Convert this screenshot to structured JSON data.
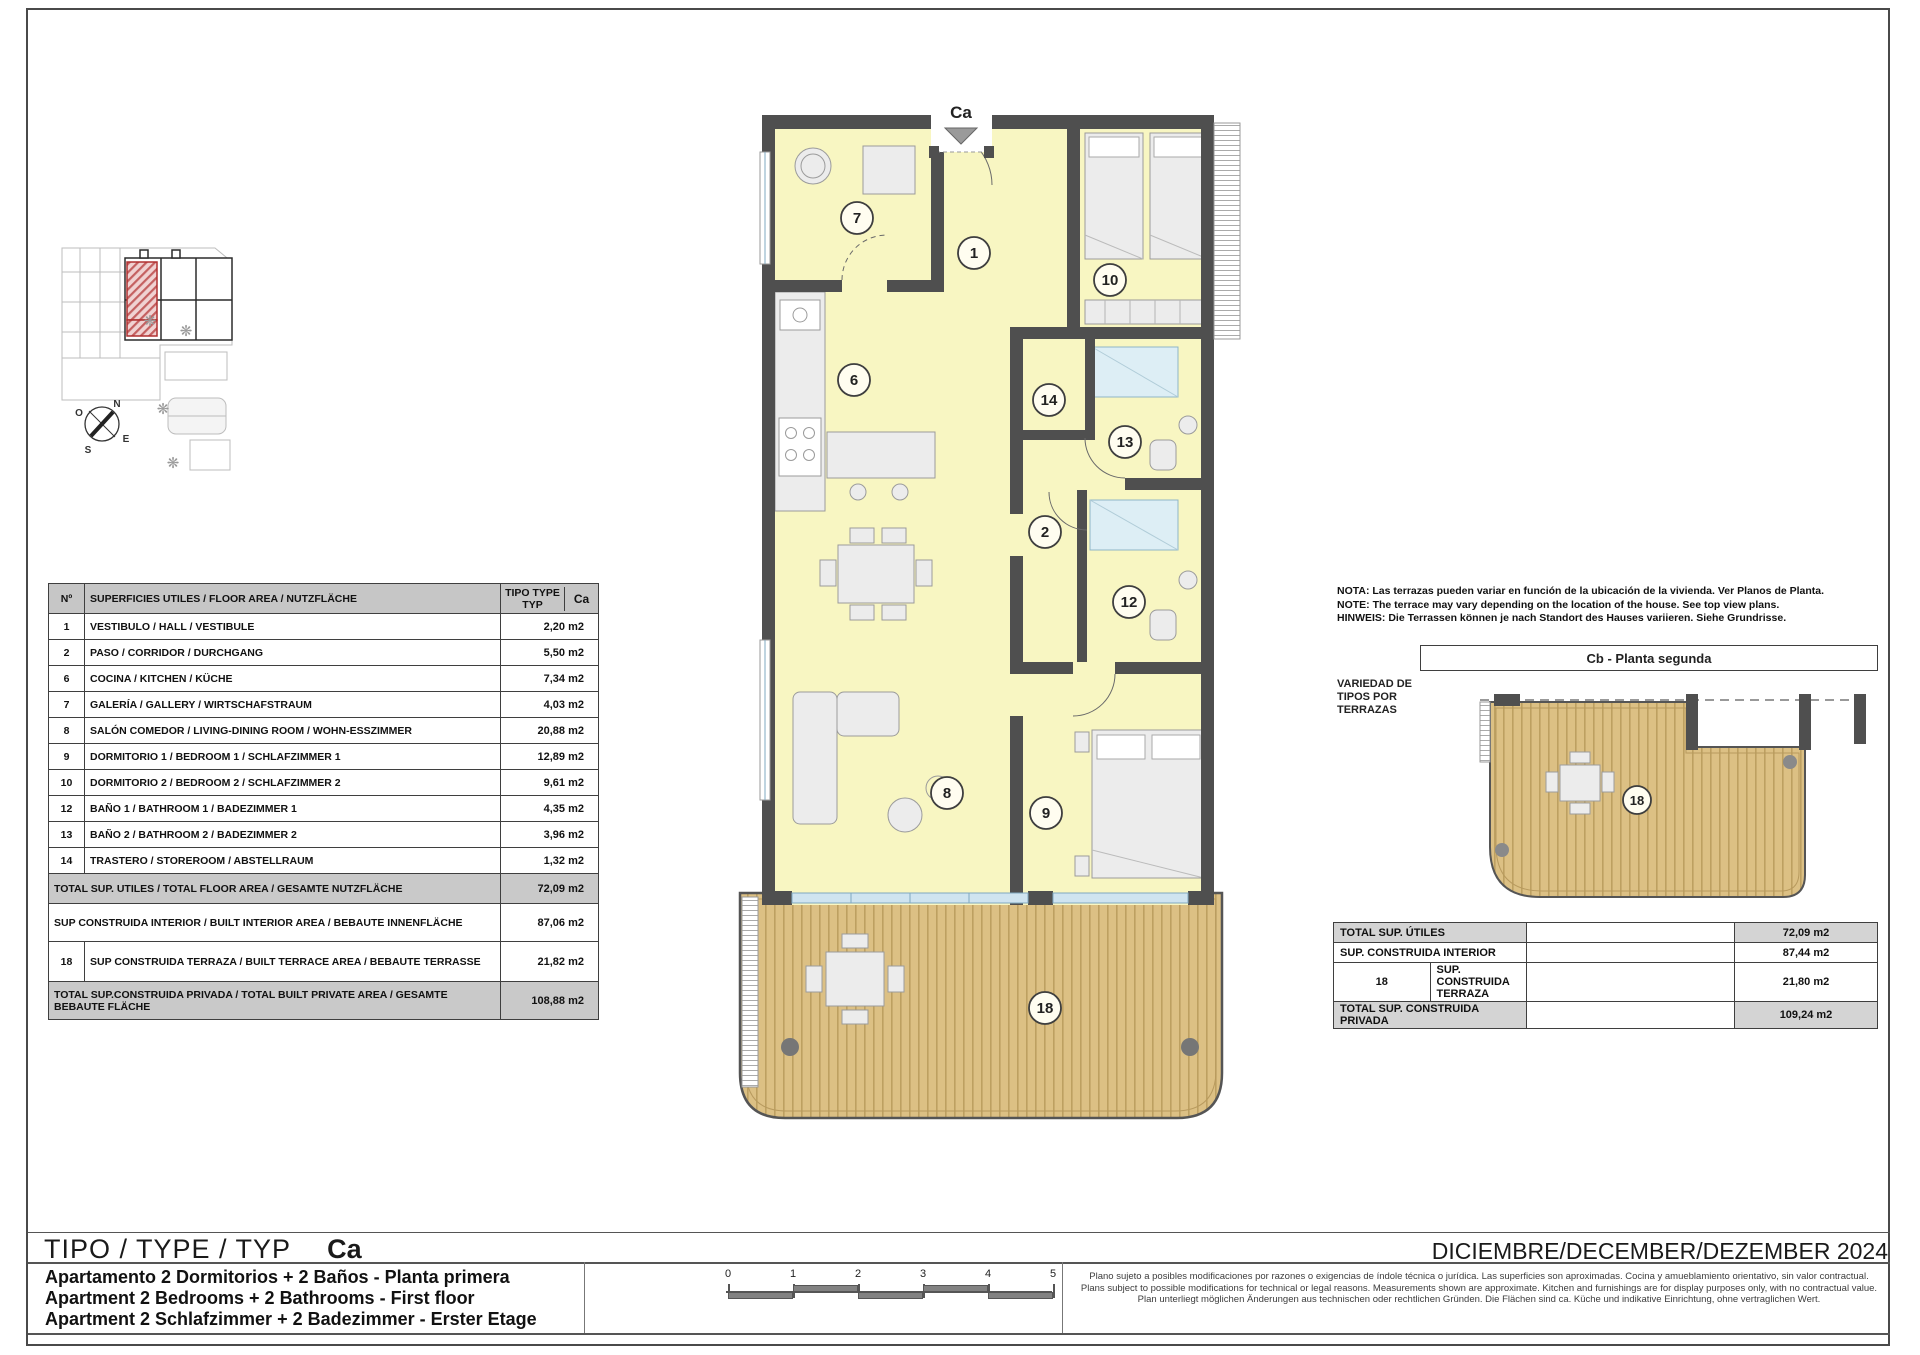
{
  "document": {
    "type_label": "TIPO / TYPE / TYP",
    "type_code": "Ca",
    "date": "DICIEMBRE/DECEMBER/DEZEMBER 2024",
    "descriptions": [
      "Apartamento 2 Dormitorios + 2 Baños - Planta primera",
      "Apartment 2 Bedrooms + 2 Bathrooms - First floor",
      "Apartment 2 Schlafzimmer + 2 Badezimmer - Erster Etage"
    ],
    "disclaimer": [
      "Plano sujeto a posibles modificaciones por razones o exigencias de índole técnica o jurídica. Las superficies son aproximadas. Cocina y amueblamiento orientativo, sin valor contractual.",
      "Plans subject to possible modifications for technical or legal reasons. Measurements shown are approximate. Kitchen and furnishings are for display purposes only, with no contractual value.",
      "Plan unterliegt möglichen Änderungen aus technischen oder rechtlichen Gründen. Die Flächen sind ca. Küche und indikative Einrichtung, ohne vertraglichen Wert."
    ]
  },
  "note": {
    "lines": [
      "NOTA: Las terrazas pueden variar en función de la ubicación de la vivienda. Ver Planos de Planta.",
      "NOTE: The terrace may vary depending on the location of the house. See top view plans.",
      "HINWEIS: Die Terrassen können je nach Standort des Hauses variieren. Siehe Grundrisse."
    ]
  },
  "areas_table": {
    "header": {
      "num": "Nº",
      "desc": "SUPERFICIES UTILES / FLOOR AREA / NUTZFLÄCHE",
      "type": "TIPO TYPE TYP",
      "variant": "Ca"
    },
    "rows": [
      {
        "num": "1",
        "desc": "VESTIBULO / HALL  / VESTIBULE",
        "value": "2,20 m2"
      },
      {
        "num": "2",
        "desc": "PASO  / CORRIDOR / DURCHGANG",
        "value": "5,50 m2"
      },
      {
        "num": "6",
        "desc": "COCINA  / KITCHEN / KÜCHE",
        "value": "7,34 m2"
      },
      {
        "num": "7",
        "desc": "GALERÍA / GALLERY / WIRTSCHAFSTRAUM",
        "value": "4,03 m2"
      },
      {
        "num": "8",
        "desc": "SALÓN COMEDOR / LIVING-DINING ROOM / WOHN-ESSZIMMER",
        "value": "20,88 m2"
      },
      {
        "num": "9",
        "desc": "DORMITORIO 1 / BEDROOM 1 / SCHLAFZIMMER 1",
        "value": "12,89 m2"
      },
      {
        "num": "10",
        "desc": "DORMITORIO 2 / BEDROOM 2 / SCHLAFZIMMER 2",
        "value": "9,61 m2"
      },
      {
        "num": "12",
        "desc": "BAÑO 1 / BATHROOM 1 / BADEZIMMER 1",
        "value": "4,35 m2"
      },
      {
        "num": "13",
        "desc": "BAÑO 2 / BATHROOM 2  / BADEZIMMER 2",
        "value": "3,96 m2"
      },
      {
        "num": "14",
        "desc": "TRASTERO / STOREROOM / ABSTELLRAUM",
        "value": "1,32 m2"
      }
    ],
    "summary": [
      {
        "num": "",
        "desc": "TOTAL SUP. UTILES / TOTAL FLOOR AREA / GESAMTE NUTZFLÄCHE",
        "value": "72,09 m2"
      },
      {
        "num": "",
        "desc": "SUP CONSTRUIDA INTERIOR / BUILT INTERIOR AREA / BEBAUTE INNENFLÄCHE",
        "value": "87,06 m2"
      },
      {
        "num": "18",
        "desc": "SUP CONSTRUIDA TERRAZA / BUILT TERRACE AREA / BEBAUTE TERRASSE",
        "value": "21,82 m2"
      },
      {
        "num": "",
        "desc": "TOTAL SUP.CONSTRUIDA PRIVADA / TOTAL  BUILT PRIVATE AREA / GESAMTE BEBAUTE FLÄCHE",
        "value": "108,88 m2"
      }
    ]
  },
  "cb_panel": {
    "title": "Cb  - Planta segunda",
    "side_label": "VARIEDAD DE TIPOS POR TERRAZAS",
    "terrace_number": "18",
    "rows": [
      {
        "num": "",
        "label": "TOTAL SUP. ÚTILES",
        "value": "72,09 m2"
      },
      {
        "num": "",
        "label": "SUP. CONSTRUIDA INTERIOR",
        "value": "87,44 m2"
      },
      {
        "num": "18",
        "label": "SUP. CONSTRUIDA TERRAZA",
        "value": "21,80 m2"
      },
      {
        "num": "",
        "label": "TOTAL SUP. CONSTRUIDA PRIVADA",
        "value": "109,24 m2"
      }
    ]
  },
  "plan": {
    "entrance_label": "Ca",
    "rooms": {
      "galeria": "7",
      "hall": "1",
      "bedroom2": "10",
      "kitchen": "6",
      "storeroom": "14",
      "bathroom2": "13",
      "corridor": "2",
      "bathroom1": "12",
      "living": "8",
      "bedroom1": "9",
      "terrace": "18"
    }
  },
  "compass": {
    "n": "N",
    "o": "O",
    "e": "E",
    "s": "S"
  },
  "scale_bar": {
    "ticks": [
      "0",
      "1",
      "2",
      "3",
      "4",
      "5"
    ]
  },
  "colors": {
    "wall": "#4f4f4f",
    "room_fill": "#f8f6c2",
    "wood": "#dcc084",
    "highlight_red": "#c46060",
    "glass": "#cfe4f0",
    "table_shade": "#c9c9c9"
  }
}
